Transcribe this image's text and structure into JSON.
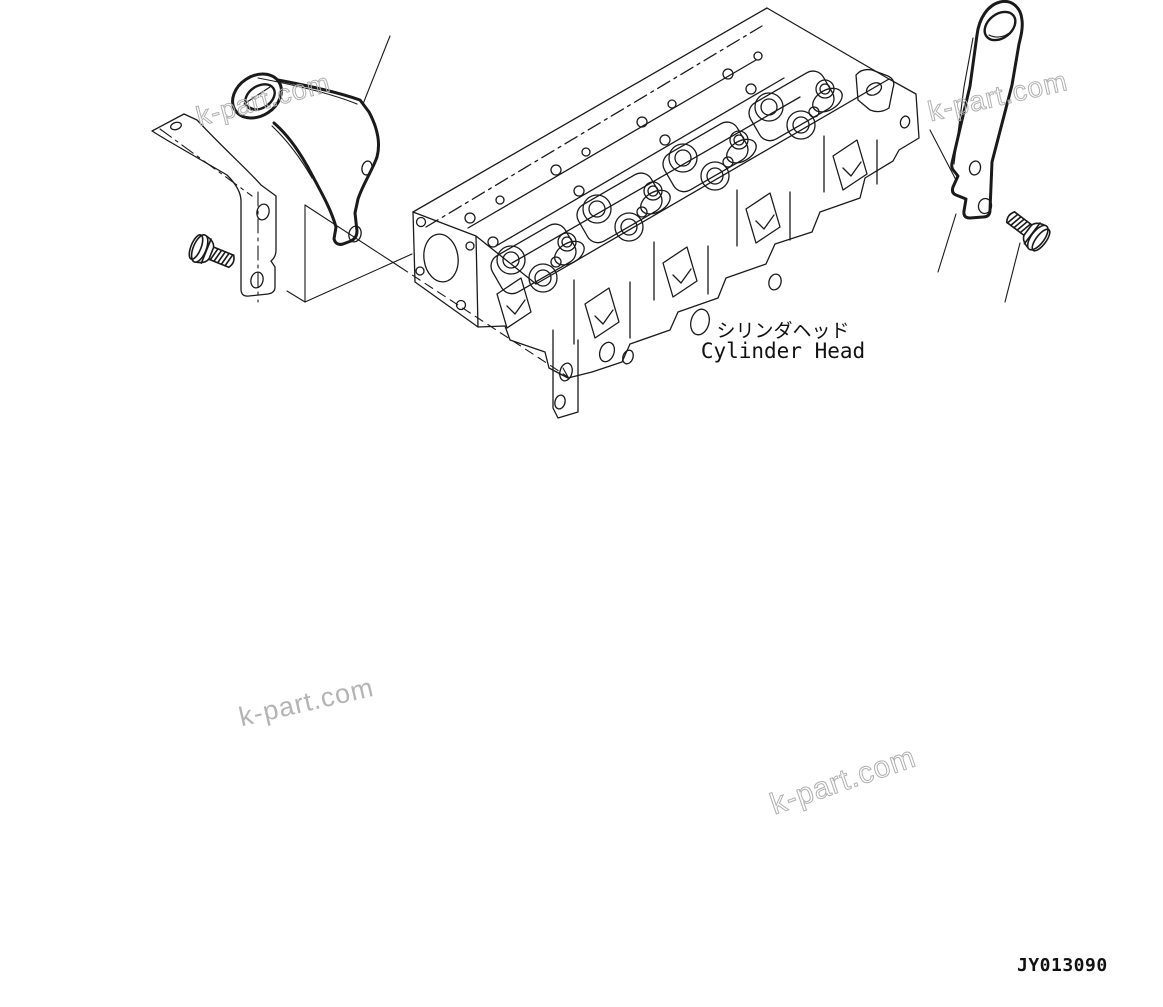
{
  "diagram": {
    "label_jp": "シリンダヘッド",
    "label_en": "Cylinder Head",
    "drawing_number": "JY013090",
    "watermark_text": "k-part.com",
    "colors": {
      "line": "#1a1a1a",
      "background": "#ffffff",
      "watermark": "#b0b0b0"
    }
  }
}
